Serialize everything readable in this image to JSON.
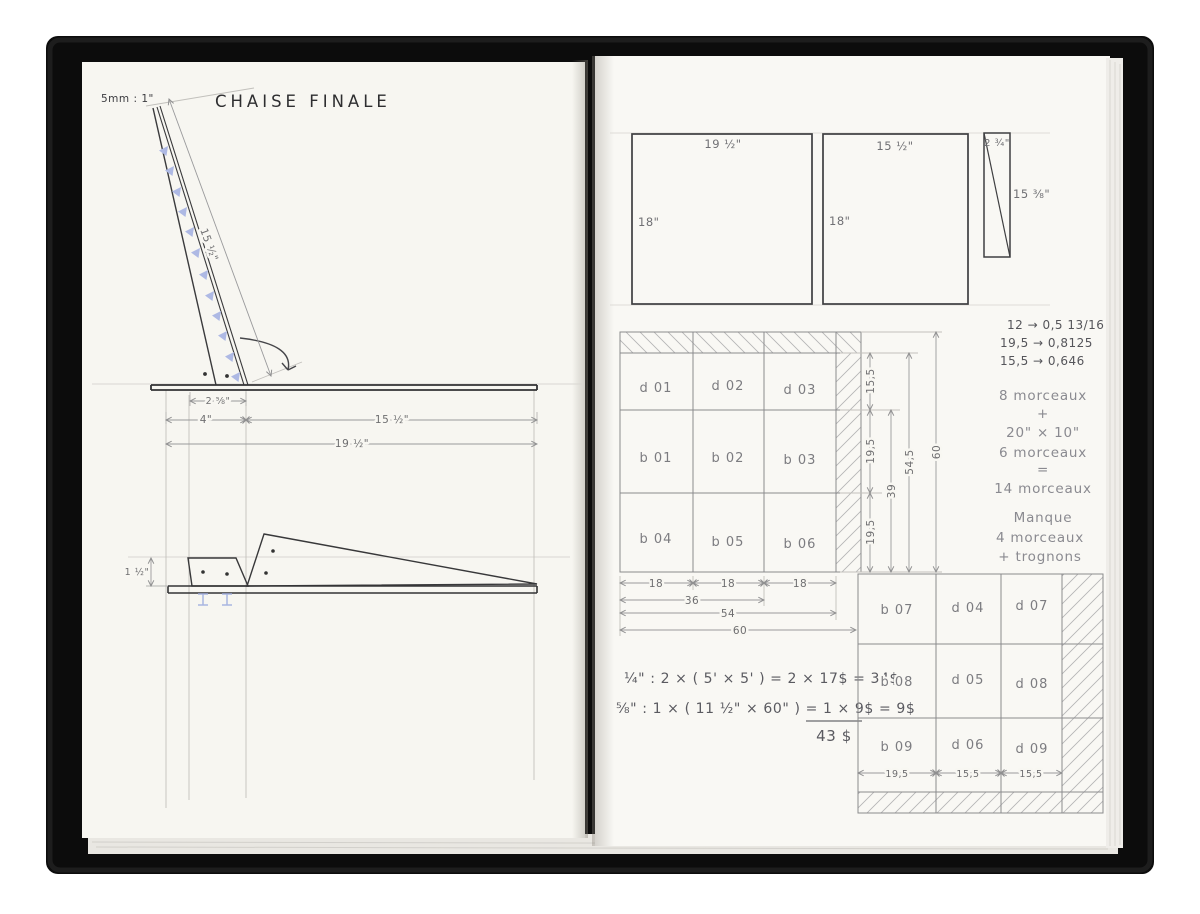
{
  "doc": {
    "title": "CHAISE FINALE",
    "scale": "5mm : 1\""
  },
  "side_view": {
    "back_len": "15 ½\"",
    "base": "2 ⅝\"",
    "front": "4\"",
    "seat": "15 ½\"",
    "total": "19 ½\"",
    "height": "1 ½\""
  },
  "panels": {
    "p1_w": "19 ½\"",
    "p1_h": "18\"",
    "p2_w": "15 ½\"",
    "p2_h": "18\"",
    "p3_w": "2 ¾\"",
    "p3_h": "15 ⅜\""
  },
  "cut1": {
    "cells": [
      "d 01",
      "d 02",
      "d 03",
      "b 01",
      "b 02",
      "b 03",
      "b 04",
      "b 05",
      "b 06"
    ],
    "cols": [
      "18",
      "18",
      "18"
    ],
    "spans": [
      "36",
      "54",
      "60"
    ],
    "rows": [
      "15,5",
      "19,5",
      "19,5"
    ],
    "rowspans": [
      "39",
      "54,5",
      "60"
    ]
  },
  "conversions": [
    "12 → 0,5  13/16",
    "19,5 → 0,8125",
    "15,5 → 0,646"
  ],
  "tally": [
    "8 morceaux",
    "+",
    "20\" × 10\"",
    "6 morceaux",
    "=",
    "14 morceaux"
  ],
  "manque": [
    "Manque",
    "4 morceaux",
    "+ trognons"
  ],
  "cost": {
    "line1": "¼\" :  2 × ( 5' × 5' ) = 2 × 17$ = 34$",
    "line2": "⅝\" :  1 × ( 11 ½\" × 60\" ) = 1 × 9$ = 9$",
    "total": "43 $"
  },
  "cut2": {
    "cells": [
      "b 07",
      "d 04",
      "d 07",
      "b 08",
      "d 05",
      "d 08",
      "b 09",
      "d 06",
      "d 09"
    ],
    "cols": [
      "19,5",
      "15,5",
      "15,5"
    ]
  }
}
